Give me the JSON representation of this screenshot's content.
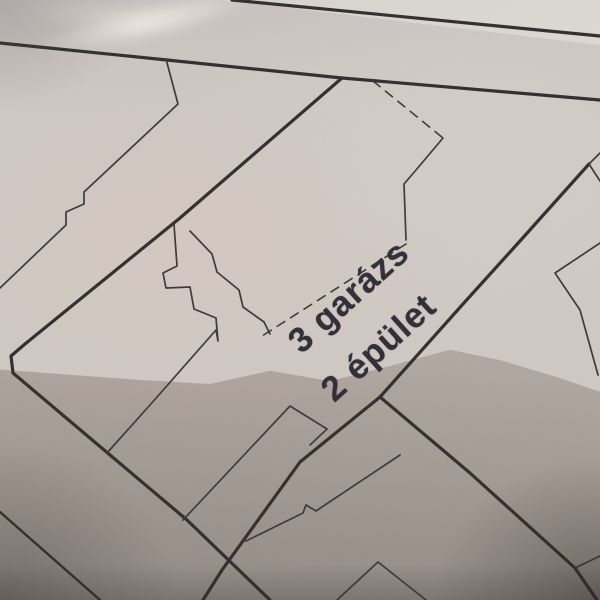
{
  "photo": {
    "subject": "hand-held photo of a paper cadastral map with a fold crease",
    "colors": {
      "paper_light": "#cdc7c3",
      "paper_pink": "#d8c7be",
      "paper_bright": "#dedad6",
      "fold_highlight": "#ece5dd",
      "paper_dark_below_fold": "#a59a91",
      "boundary_line": "#2e2b29",
      "building_line": "#3a3632",
      "text": "#33303a"
    }
  },
  "map": {
    "labels": [
      {
        "text": "3 garázs",
        "cx": 349,
        "cy": 297,
        "angle_deg": -42,
        "font_size_px": 35
      },
      {
        "text": "2 épület",
        "cx": 379,
        "cy": 348,
        "angle_deg": -42,
        "font_size_px": 35
      }
    ],
    "line_groups": [
      {
        "name": "parcel-boundary-line",
        "stroke_color": "boundary_line",
        "width": 3.2,
        "dash": null,
        "lines": [
          {
            "name": "street-upper-line",
            "points": [
              [
                232,
                0
              ],
              [
                600,
                36
              ]
            ]
          },
          {
            "name": "street-lower-line",
            "points": [
              [
                0,
                43
              ],
              [
                167,
                60
              ],
              [
                342,
                78
              ],
              [
                600,
                100
              ]
            ]
          },
          {
            "name": "boundary-northwest-diagonal",
            "points": [
              [
                342,
                78
              ],
              [
                180,
                218
              ],
              [
                25,
                344
              ],
              [
                11,
                356
              ],
              [
                13,
                373
              ]
            ]
          },
          {
            "name": "boundary-southwest-diagonal",
            "points": [
              [
                13,
                373
              ],
              [
                110,
                455
              ],
              [
                187,
                520
              ],
              [
                270,
                600
              ]
            ]
          },
          {
            "name": "boundary-east-diagonal",
            "points": [
              [
                589,
                164
              ],
              [
                520,
                241
              ],
              [
                463,
                304
              ],
              [
                380,
                397
              ]
            ]
          },
          {
            "name": "boundary-southeast-diagonal",
            "points": [
              [
                380,
                397
              ],
              [
                470,
                473
              ],
              [
                575,
                568
              ],
              [
                597,
                600
              ]
            ]
          },
          {
            "name": "boundary-mid-diagonal",
            "points": [
              [
                380,
                397
              ],
              [
                300,
                462
              ],
              [
                222,
                570
              ],
              [
                203,
                600
              ]
            ]
          }
        ]
      },
      {
        "name": "parcel-boundary-line-secondary",
        "stroke_color": "boundary_line",
        "width": 2.4,
        "dash": null,
        "lines": [
          {
            "name": "boundary-bottomleft-parallel",
            "points": [
              [
                0,
                512
              ],
              [
                100,
                600
              ]
            ]
          }
        ]
      },
      {
        "name": "building-outline-line",
        "stroke_color": "building_line",
        "width": 1.7,
        "dash": null,
        "lines": [
          {
            "name": "northwest-parcel-edge",
            "points": [
              [
                166,
                59
              ],
              [
                178,
                104
              ],
              [
                84,
                192
              ],
              [
                84,
                204
              ],
              [
                66,
                212
              ],
              [
                66,
                225
              ],
              [
                0,
                288
              ]
            ]
          },
          {
            "name": "building-right-edge",
            "points": [
              [
                443,
                138
              ],
              [
                416,
                170
              ],
              [
                404,
                184
              ],
              [
                406,
                240
              ]
            ]
          },
          {
            "name": "garage-stair-left-edge",
            "points": [
              [
                174,
                224
              ],
              [
                177,
                266
              ],
              [
                163,
                273
              ],
              [
                166,
                288
              ],
              [
                190,
                287
              ],
              [
                194,
                309
              ],
              [
                216,
                318
              ],
              [
                218,
                341
              ],
              [
                216,
                330
              ],
              [
                150,
                405
              ],
              [
                107,
                453
              ]
            ]
          },
          {
            "name": "garage-stair-right-edge",
            "points": [
              [
                190,
                231
              ],
              [
                212,
                254
              ],
              [
                217,
                272
              ],
              [
                239,
                290
              ],
              [
                243,
                307
              ],
              [
                264,
                322
              ],
              [
                270,
                334
              ]
            ]
          },
          {
            "name": "small-building-south",
            "points": [
              [
                327,
                429
              ],
              [
                290,
                406
              ],
              [
                183,
                520
              ]
            ]
          },
          {
            "name": "small-building-notch",
            "points": [
              [
                327,
                429
              ],
              [
                310,
                445
              ]
            ]
          },
          {
            "name": "long-building-top",
            "points": [
              [
                246,
                541
              ],
              [
                303,
                513
              ],
              [
                306,
                505
              ],
              [
                316,
                511
              ],
              [
                400,
                455
              ]
            ]
          },
          {
            "name": "bottom-building-gable",
            "points": [
              [
                337,
                600
              ],
              [
                378,
                562
              ],
              [
                426,
                600
              ]
            ]
          },
          {
            "name": "east-parcel-corner-upper",
            "points": [
              [
                600,
                153
              ],
              [
                589,
                164
              ],
              [
                600,
                181
              ]
            ]
          },
          {
            "name": "east-parcel-corner-lower",
            "points": [
              [
                600,
                243
              ],
              [
                555,
                273
              ],
              [
                580,
                310
              ],
              [
                598,
                375
              ]
            ]
          },
          {
            "name": "southeast-corner-branch",
            "points": [
              [
                575,
                568
              ],
              [
                600,
                556
              ]
            ]
          }
        ]
      },
      {
        "name": "dashed-survey-line",
        "stroke_color": "building_line",
        "width": 1.6,
        "dash": "9 7",
        "lines": [
          {
            "name": "dashed-branch-northeast",
            "points": [
              [
                373,
                81
              ],
              [
                443,
                138
              ]
            ]
          },
          {
            "name": "dashed-line-above-label",
            "points": [
              [
                406,
                244
              ],
              [
                262,
                336
              ]
            ]
          }
        ]
      }
    ]
  }
}
